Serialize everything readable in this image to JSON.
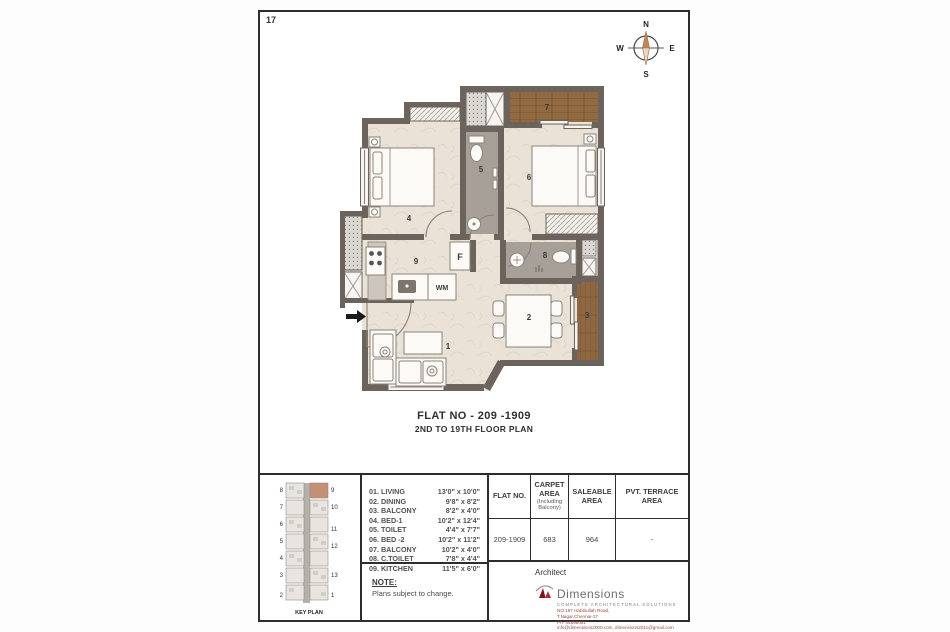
{
  "page": {
    "number": "17"
  },
  "compass": {
    "n": "N",
    "e": "E",
    "s": "S",
    "w": "W"
  },
  "plan": {
    "title_line1": "FLAT NO - 209 -1909",
    "title_line2": "2ND TO 19TH FLOOR PLAN",
    "rooms": {
      "living": "1",
      "dining": "2",
      "balcony_dining": "3",
      "bed1": "4",
      "toilet": "5",
      "bed2": "6",
      "balcony_bed": "7",
      "c_toilet": "8",
      "kitchen": "9"
    },
    "appliances": {
      "fridge": "F",
      "washing_machine": "WM"
    }
  },
  "legend": {
    "items": [
      {
        "name": "01. LIVING",
        "dim": "13'0\" x 10'0\""
      },
      {
        "name": "02. DINING",
        "dim": "9'8\" x 8'2\""
      },
      {
        "name": "03. BALCONY",
        "dim": "8'2\" x 4'0\""
      },
      {
        "name": "04. BED-1",
        "dim": "10'2\" x 12'4\""
      },
      {
        "name": "05. TOILET",
        "dim": "4'4\" x 7'7\""
      },
      {
        "name": "06. BED -2",
        "dim": "10'2\" x 11'2\""
      },
      {
        "name": "07. BALCONY",
        "dim": "10'2\" x 4'0\""
      },
      {
        "name": "08. C.TOILET",
        "dim": "7'8\" x 4'4\""
      },
      {
        "name": "09. KITCHEN",
        "dim": "11'5\" x 6'0\""
      }
    ]
  },
  "note": {
    "title": "NOTE:",
    "body": "Plans subject to change."
  },
  "area_table": {
    "headers": {
      "flat_no": "FLAT NO.",
      "carpet": "CARPET AREA",
      "carpet_sub": "(Including Balcony)",
      "saleable": "SALEABLE AREA",
      "terrace": "PVT. TERRACE AREA"
    },
    "row": {
      "flat_no": "209-1909",
      "carpet": "683",
      "saleable": "964",
      "terrace": "-"
    }
  },
  "architect": {
    "label": "Architect",
    "brand": "Dimensions",
    "tagline": "COMPLETE ARCHITECTURAL SOLUTIONS",
    "address1": "NO.187 Habibullah Road,",
    "address2": "T.Nagar,Chennai-17",
    "phone": "Ph- 44598081",
    "email": "info@dimensions2000.com, dimensions2011@gmail.com"
  },
  "keyplan": {
    "caption": "KEY PLAN",
    "left": [
      "8",
      "7",
      "6",
      "5",
      "4",
      "3",
      "2"
    ],
    "right": [
      "9",
      "10",
      "11",
      "12",
      "13",
      "1"
    ]
  },
  "colors": {
    "wall": "#6b635c",
    "floor": "#eae2d6",
    "wood": "#8f6843",
    "toilet_floor": "#a7a098",
    "highlight": "#c38f75",
    "brand_red": "#8e1f1f",
    "address_red": "#9b4a3f"
  }
}
